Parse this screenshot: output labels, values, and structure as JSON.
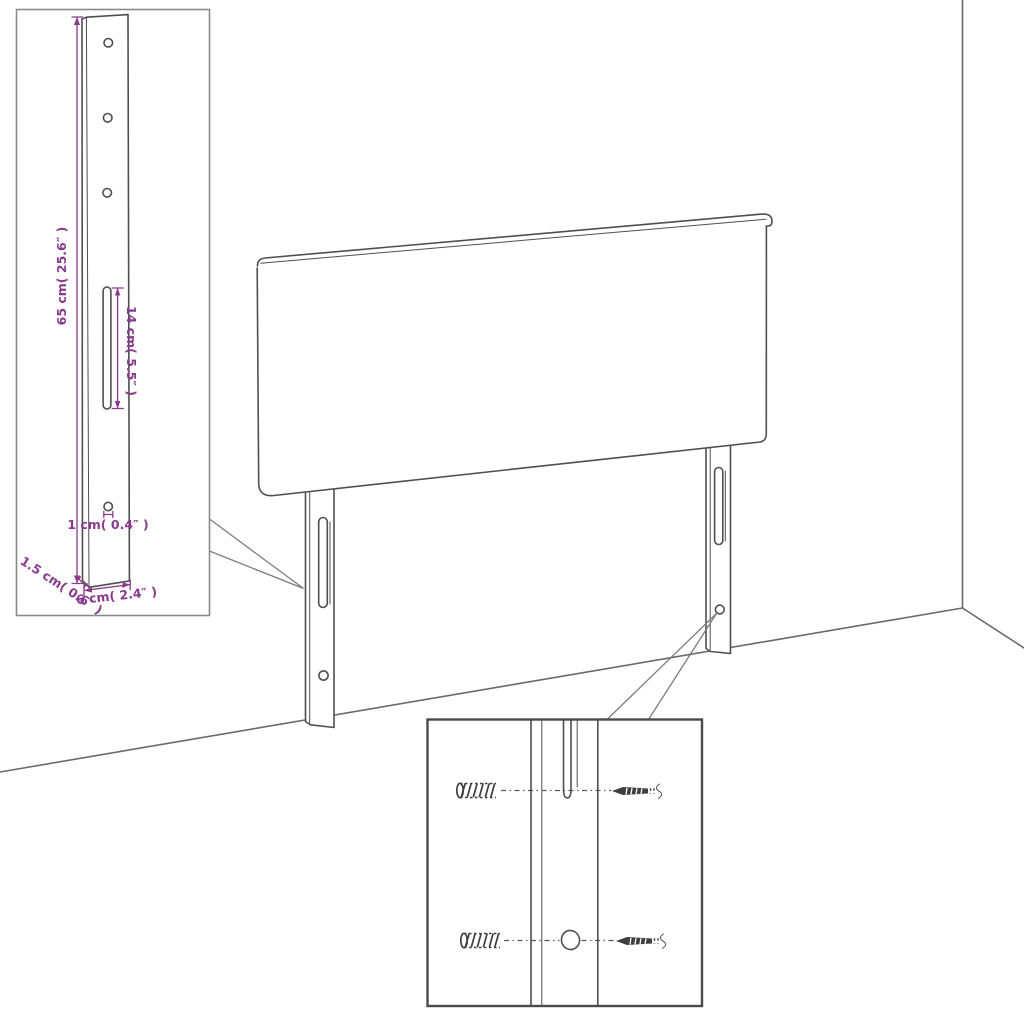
{
  "colors": {
    "accent": "#8a3a8c",
    "line": "#4f4f4f",
    "wall": "#6a6a6a",
    "background": "#ffffff"
  },
  "detail_inset": {
    "dim_height": "65 cm( 25.6″ )",
    "dim_slot": "14 cm( 5.5″ )",
    "dim_hole": "1 cm( 0.4″ )",
    "dim_thickness": "1.5 cm( 0.6″ )",
    "dim_width": "6 cm( 2.4″ )"
  }
}
